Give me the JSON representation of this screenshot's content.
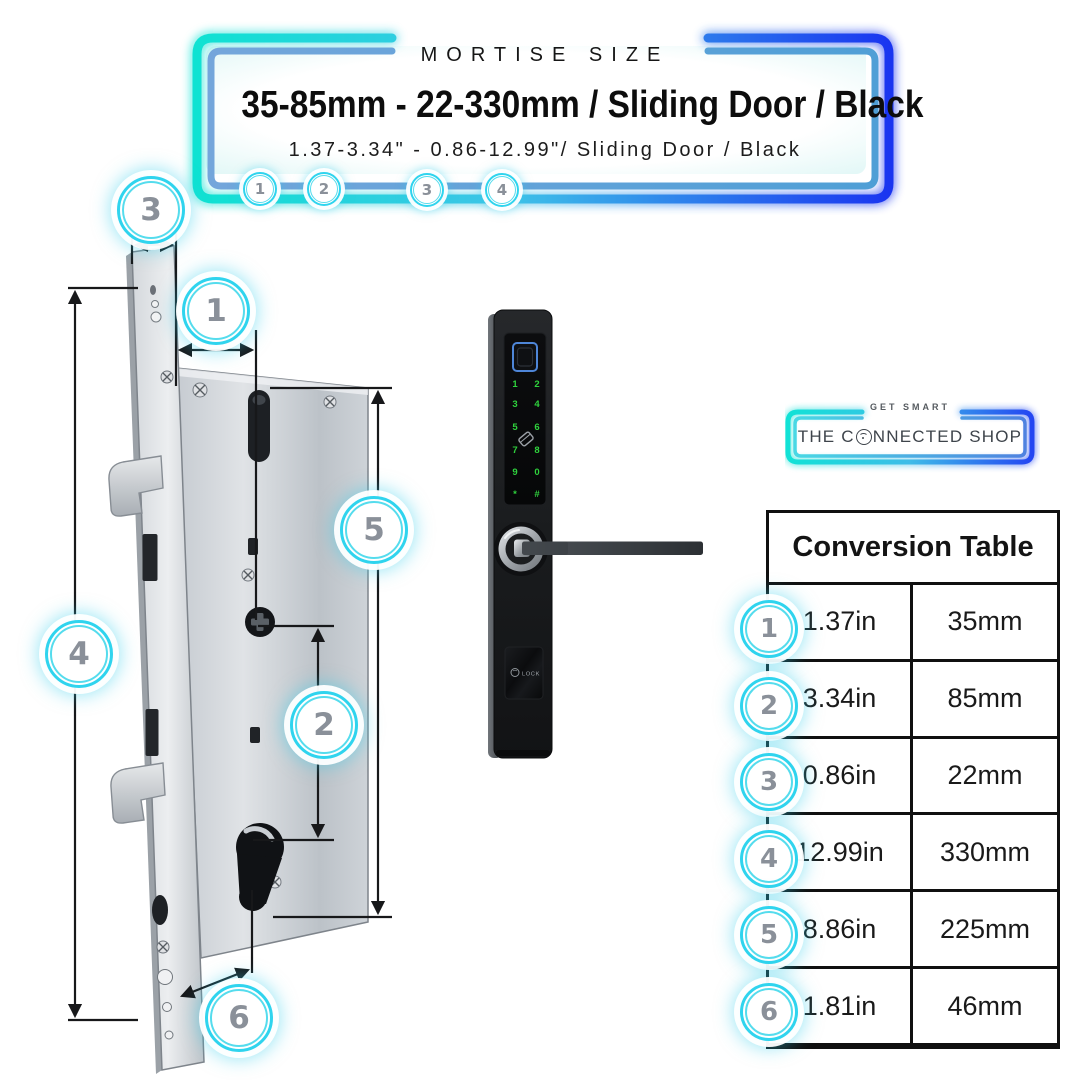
{
  "header": {
    "eyebrow": "MORTISE SIZE",
    "title": "35-85mm - 22-330mm / Sliding Door / Black",
    "subtitle": "1.37-3.34\" - 0.86-12.99\"/ Sliding Door / Black",
    "badges": [
      "1",
      "2",
      "3",
      "4"
    ]
  },
  "diagram": {
    "callouts": [
      {
        "label": "3"
      },
      {
        "label": "1"
      },
      {
        "label": "5"
      },
      {
        "label": "4"
      },
      {
        "label": "2"
      },
      {
        "label": "6"
      }
    ]
  },
  "product": {
    "keypad": [
      "1",
      "2",
      "3",
      "4",
      "5",
      "6",
      "7",
      "8",
      "9",
      "0",
      "*",
      "#"
    ],
    "lock_label": "LOCK"
  },
  "logo": {
    "tagline": "GET SMART",
    "name_part1": "THE C",
    "name_part2": "NNECTED SHOP"
  },
  "conversion_table": {
    "title": "Conversion Table",
    "rows": [
      {
        "num": "1",
        "inches": "1.37in",
        "mm": "35mm"
      },
      {
        "num": "2",
        "inches": "3.34in",
        "mm": "85mm"
      },
      {
        "num": "3",
        "inches": "0.86in",
        "mm": "22mm"
      },
      {
        "num": "4",
        "inches": "12.99in",
        "mm": "330mm"
      },
      {
        "num": "5",
        "inches": "8.86in",
        "mm": "225mm"
      },
      {
        "num": "6",
        "inches": "1.81in",
        "mm": "46mm"
      }
    ]
  },
  "colors": {
    "accent_cyan": "#17E3D6",
    "accent_blue": "#1733EF",
    "badge_ring": "#2FD4EE",
    "badge_number": "#8A9099",
    "keypad_green": "#2FD23D",
    "fingerprint_blue": "#4E86D8",
    "table_border": "#101010"
  }
}
